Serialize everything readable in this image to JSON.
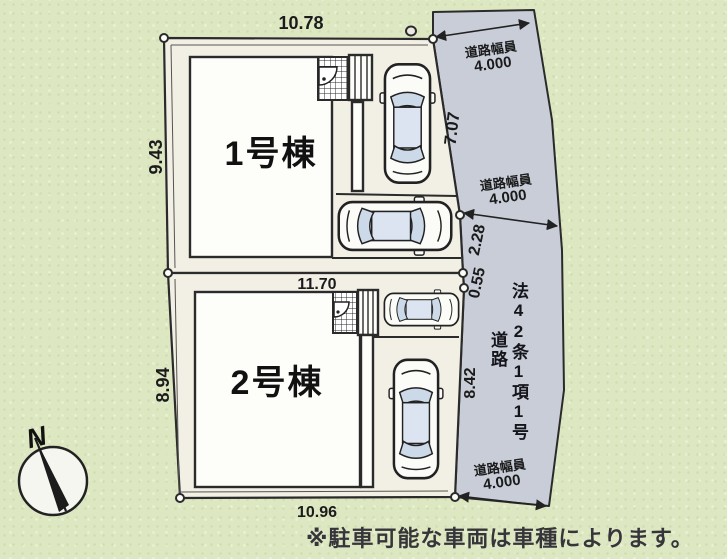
{
  "plan": {
    "compass_label": "N",
    "note": "※駐車可能な車両は車種によります。",
    "buildings": [
      {
        "label": "1号棟"
      },
      {
        "label": "2号棟"
      }
    ],
    "dimensions": {
      "lot1_top": "10.78",
      "lot1_left": "9.43",
      "lot2_left": "8.94",
      "lot_divider": "11.70",
      "lot2_bottom": "10.96",
      "frontage_upper": "7.07",
      "frontage_mid": "2.28",
      "frontage_small": "0.55",
      "frontage_lower": "8.42"
    },
    "road": {
      "width_label": "道路幅員",
      "width_value": "4.000",
      "name_part1": "法42条1項1号",
      "name_part2": "道路"
    },
    "colors": {
      "background": "#dde8c3",
      "lot_fill": "#f2efe5",
      "road_fill": "#c8cdd7",
      "line": "#2b2b2b",
      "car_glass": "#ccd9e8"
    }
  }
}
